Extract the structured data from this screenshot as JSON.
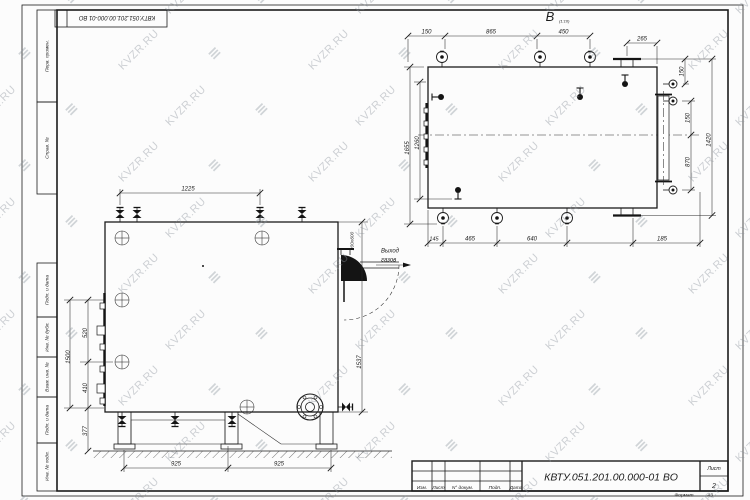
{
  "watermark": {
    "text": "KVZR.RU",
    "logo": "≡"
  },
  "frame": {
    "top_stamp": "КВТУ.051.201.00.000-01 ВО",
    "side_top": [
      "Перв. примен.",
      "Справ. №"
    ],
    "side_bottom": [
      "Подп. и дата",
      "Инв. № дубл.",
      "Взам. инв. №",
      "Подп. и дата",
      "Инв. № подл."
    ],
    "format_label": "Формат",
    "format_value": "А3"
  },
  "title_block": {
    "doc": "КВТУ.051.201.00.000-01 ВО",
    "cols": [
      "Изм.",
      "Лист",
      "N° докум.",
      "Подп.",
      "Дата"
    ],
    "sheet_label": "Лист",
    "sheet_value": "2"
  },
  "views": {
    "front": {
      "dim_top": "1225",
      "left": [
        "1500",
        "520",
        "410",
        "377"
      ],
      "right_duct": "200х600",
      "right_height": "1537",
      "bottom": [
        "925",
        "925"
      ],
      "callout": [
        "Выход",
        "газов"
      ]
    },
    "top": {
      "label": "В",
      "scale": "(1:10)",
      "top": [
        "150",
        "865",
        "450",
        "265"
      ],
      "right": [
        "150",
        "150",
        "870",
        "1420"
      ],
      "left": [
        "1655",
        "1260"
      ],
      "bottom": [
        "145",
        "465",
        "640",
        "185"
      ]
    }
  },
  "colors": {
    "line": "#1b1b1b",
    "paper": "#fcfcfc",
    "watermark": "#8a929b"
  }
}
